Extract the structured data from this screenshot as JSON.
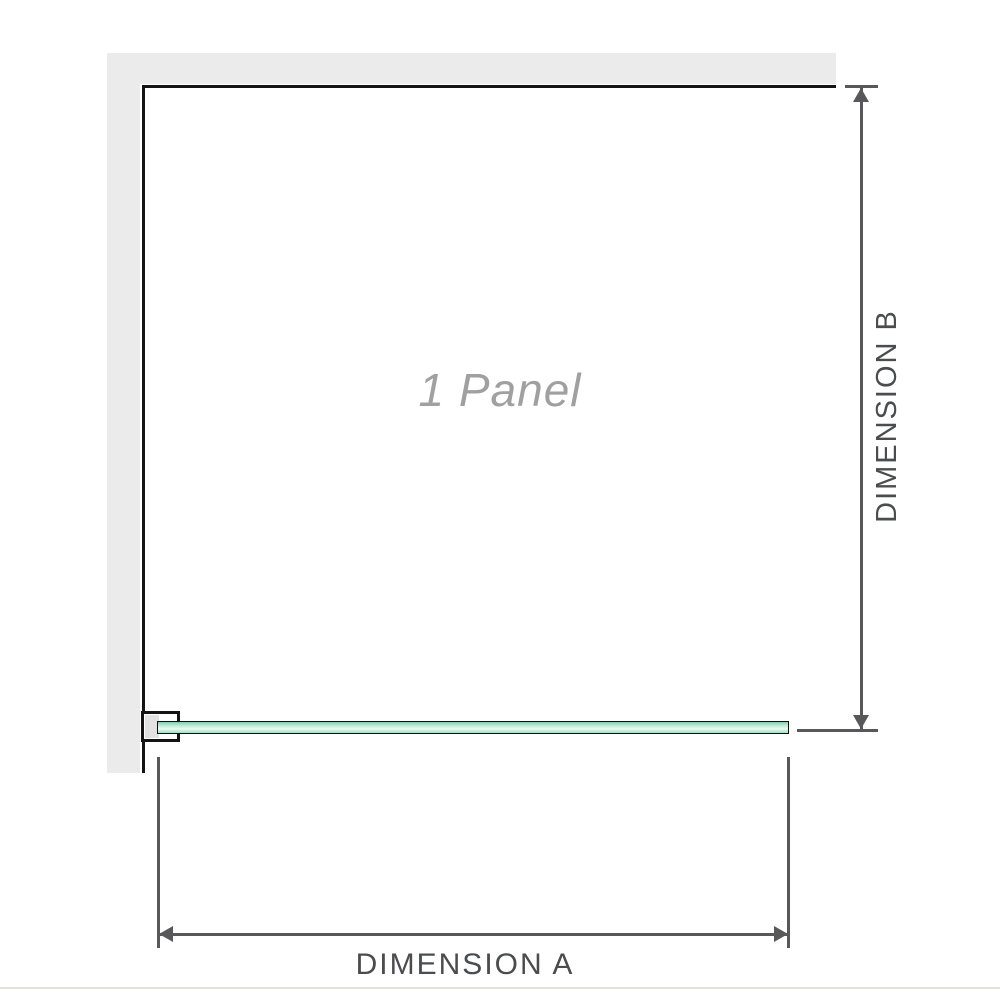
{
  "diagram": {
    "panel_label": "1 Panel",
    "dimension_a_label": "DIMENSION A",
    "dimension_b_label": "DIMENSION B"
  },
  "colors": {
    "wall": "#ebebeb",
    "outline": "#141414",
    "dimension": "#58585a",
    "label_text": "#4b4c4e",
    "panel_text": "#a0a0a0",
    "glass_top": "#82ccab",
    "glass_mid": "#ecf9f2",
    "glass_bottom": "#a7dec4"
  }
}
